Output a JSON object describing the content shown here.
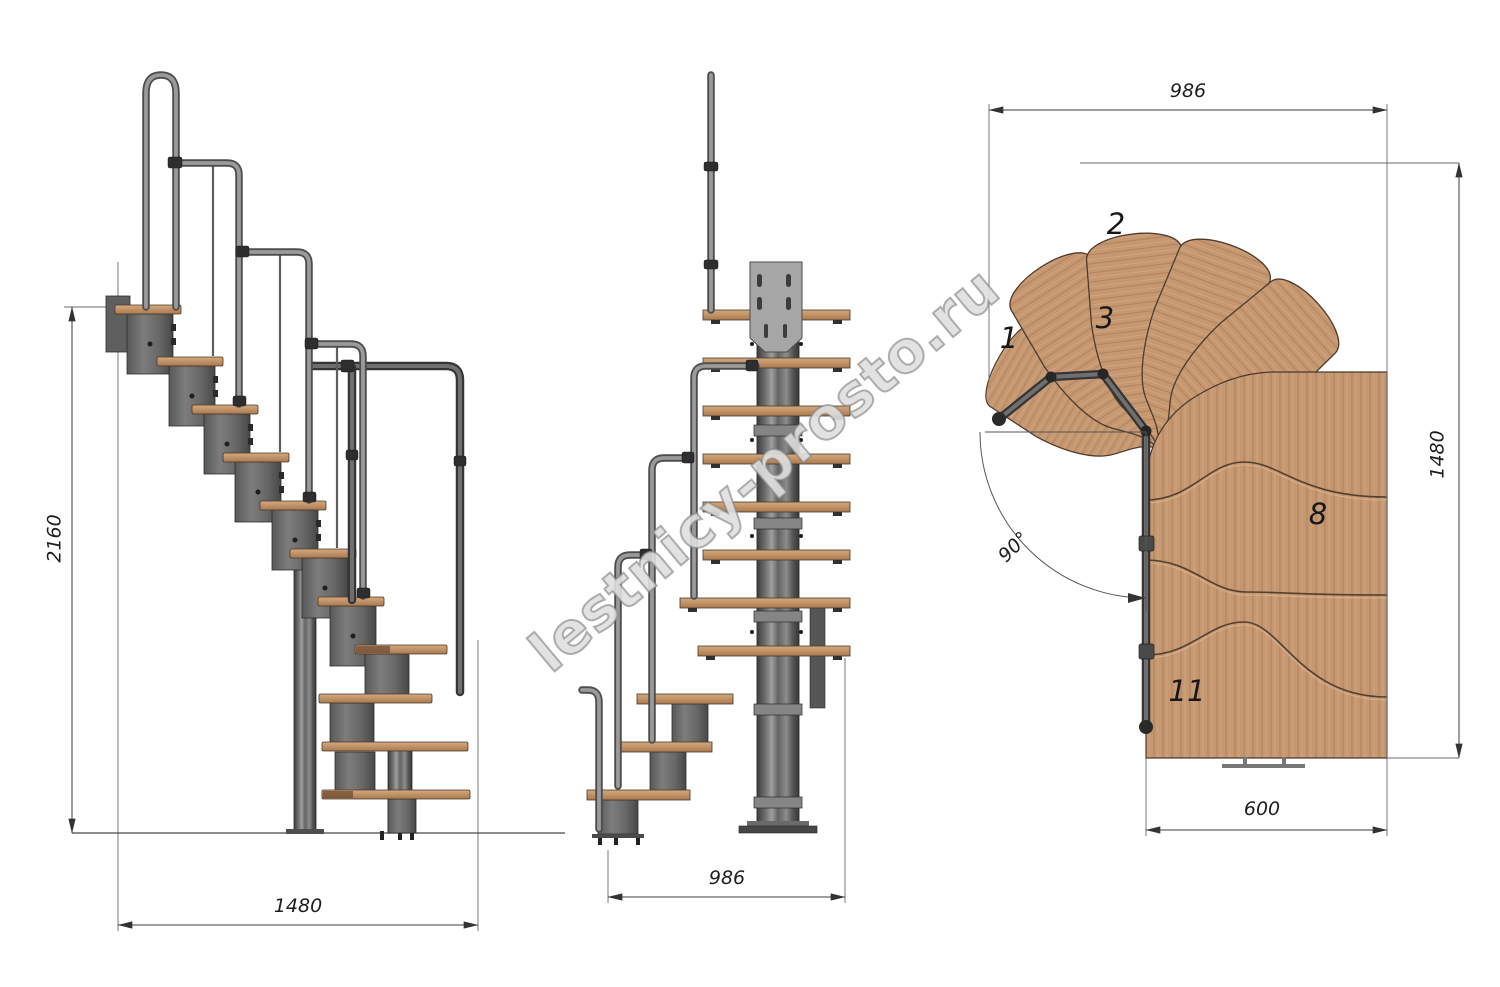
{
  "watermark": "lestnicy-prosto.ru",
  "drawing": {
    "type": "staircase-technical-drawing",
    "views": [
      "side-elevation",
      "front-elevation",
      "plan"
    ],
    "colors": {
      "wood": "#c59872",
      "metal": "#6b6b6b",
      "line": "#3c3c3c"
    }
  },
  "labels": {
    "side_height": "2160",
    "side_width": "1480",
    "front_width": "986",
    "plan_width": "986",
    "plan_depth": "1480",
    "plan_flight_width": "600",
    "plan_angle": "90°"
  },
  "tread_numbers": [
    "1",
    "2",
    "3",
    "8",
    "11"
  ]
}
